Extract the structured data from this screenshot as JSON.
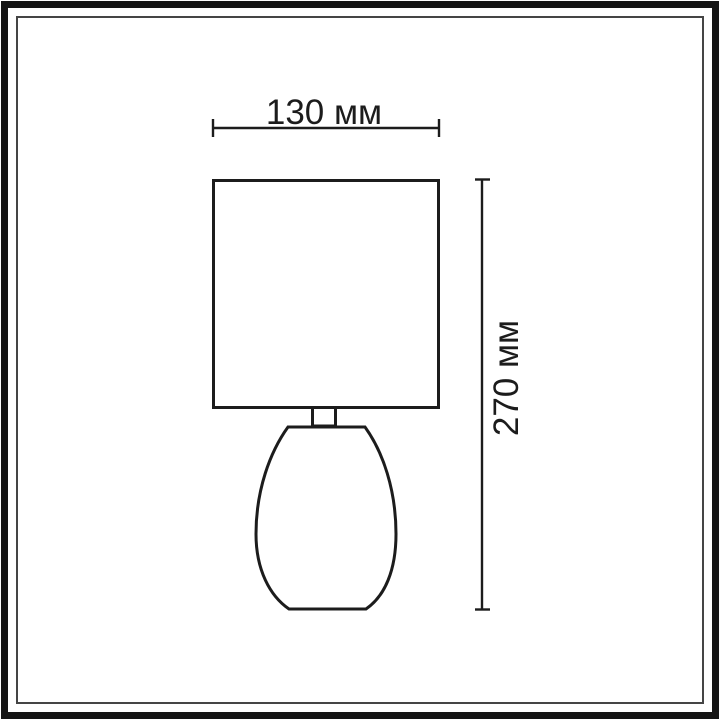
{
  "diagram": {
    "type": "technical-dimension-drawing",
    "subject": "table lamp outline (rectangular shade on teardrop base)",
    "dimensions": {
      "width": {
        "label": "130 мм",
        "value": 130,
        "unit": "мм",
        "orientation": "horizontal"
      },
      "height": {
        "label": "270 мм",
        "value": 270,
        "unit": "мм",
        "orientation": "vertical"
      }
    }
  },
  "colors": {
    "background": "#ffffff",
    "line": "#1c1c1c",
    "frame_outer": "#141414",
    "frame_inner_line": "#454545"
  }
}
